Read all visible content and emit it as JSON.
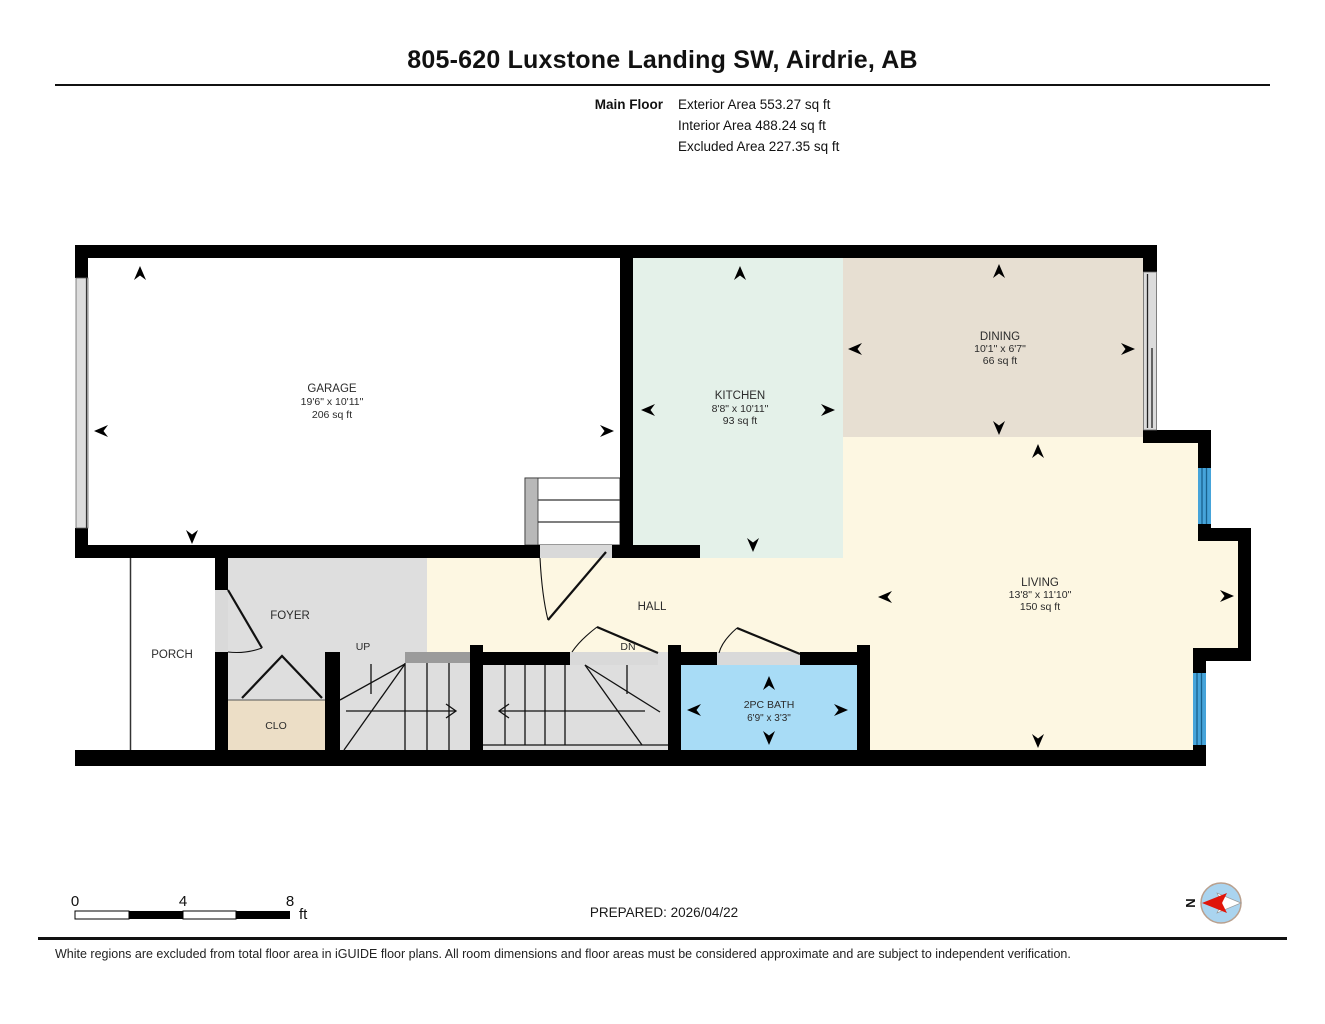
{
  "header": {
    "title": "805-620 Luxstone Landing SW, Airdrie, AB",
    "floor_label": "Main Floor",
    "area_lines": [
      "Exterior Area 553.27 sq ft",
      "Interior Area 488.24 sq ft",
      "Excluded Area 227.35 sq ft"
    ]
  },
  "rooms": {
    "garage": {
      "name": "GARAGE",
      "dims": "19'6\" x 10'11\"",
      "area": "206 sq ft"
    },
    "kitchen": {
      "name": "KITCHEN",
      "dims": "8'8\" x 10'11\"",
      "area": "93 sq ft"
    },
    "dining": {
      "name": "DINING",
      "dims": "10'1\" x 6'7\"",
      "area": "66 sq ft"
    },
    "living": {
      "name": "LIVING",
      "dims": "13'8\" x 11'10\"",
      "area": "150 sq ft"
    },
    "bath": {
      "name": "2PC BATH",
      "dims": "6'9\" x 3'3\""
    },
    "hall": {
      "name": "HALL"
    },
    "foyer": {
      "name": "FOYER"
    },
    "porch": {
      "name": "PORCH"
    },
    "closet": {
      "name": "CLO"
    },
    "stairs_up": {
      "label": "UP"
    },
    "stairs_down": {
      "label": "DN"
    }
  },
  "scale_bar": {
    "ticks": [
      "0",
      "4",
      "8"
    ],
    "unit": "ft"
  },
  "prepared_label": "PREPARED: 2026/04/22",
  "compass": {
    "label": "N"
  },
  "footer": {
    "disclaimer": "White regions are excluded from total floor area in iGUIDE floor plans. All room dimensions and floor areas must be considered approximate and are subject to independent verification."
  },
  "colors": {
    "wall": "#000000",
    "kitchen": "#e4f1e9",
    "dining": "#e7dfd2",
    "living_hall": "#fdf7e2",
    "foyer_stairs": "#dedede",
    "closet": "#ecdec6",
    "bath": "#a8dcf6",
    "excluded": "#ffffff",
    "window": "#46a4da",
    "door_sill": "#d9d9d9",
    "stair_bar": "#9b9b9b",
    "compass_red": "#e0150a",
    "compass_blue": "#aad4ef"
  }
}
